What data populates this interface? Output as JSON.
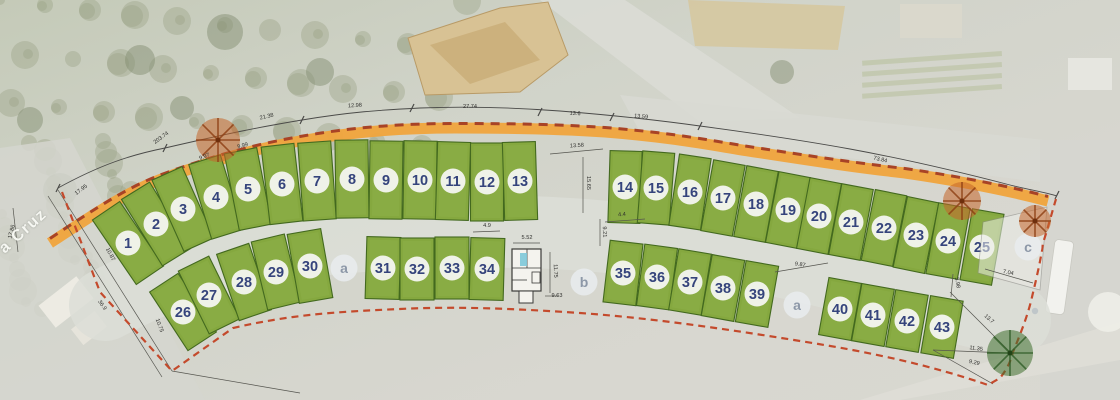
{
  "map": {
    "street_label": "a Cruz",
    "colors": {
      "plot_green": "#85a83f",
      "plot_green_light": "#93b44c",
      "plot_border": "#43691f",
      "road_orange": "#f0a43c",
      "boundary_red_dash": "#c44a2c",
      "road_overlay_dash": "#a84326",
      "measure_line": "#4a4a48",
      "number_text": "#35447c",
      "letter_text": "#8d98a8",
      "tree_orange": "#c4662a",
      "tree_green": "#3f7030",
      "building_tan": "#d8c294"
    },
    "plot_rows": [
      {
        "name": "row-north-west",
        "w": 33,
        "h": 78,
        "plots": [
          {
            "n": "1",
            "x": 128,
            "y": 243
          },
          {
            "n": "2",
            "x": 156,
            "y": 224
          },
          {
            "n": "3",
            "x": 183,
            "y": 209
          },
          {
            "n": "4",
            "x": 216,
            "y": 197
          },
          {
            "n": "5",
            "x": 248,
            "y": 189
          },
          {
            "n": "6",
            "x": 282,
            "y": 184
          },
          {
            "n": "7",
            "x": 317,
            "y": 181
          },
          {
            "n": "8",
            "x": 352,
            "y": 179
          },
          {
            "n": "9",
            "x": 386,
            "y": 180
          },
          {
            "n": "10",
            "x": 420,
            "y": 180
          },
          {
            "n": "11",
            "x": 453,
            "y": 181
          },
          {
            "n": "12",
            "x": 487,
            "y": 182
          },
          {
            "n": "13",
            "x": 520,
            "y": 181
          }
        ]
      },
      {
        "name": "row-north-east",
        "w": 32,
        "h": 72,
        "plots": [
          {
            "n": "14",
            "x": 625,
            "y": 187
          },
          {
            "n": "15",
            "x": 656,
            "y": 188
          },
          {
            "n": "16",
            "x": 690,
            "y": 192
          },
          {
            "n": "17",
            "x": 723,
            "y": 198
          },
          {
            "n": "18",
            "x": 756,
            "y": 204
          },
          {
            "n": "19",
            "x": 788,
            "y": 210
          },
          {
            "n": "20",
            "x": 819,
            "y": 216
          },
          {
            "n": "21",
            "x": 851,
            "y": 222
          },
          {
            "n": "22",
            "x": 884,
            "y": 228
          },
          {
            "n": "23",
            "x": 916,
            "y": 235
          },
          {
            "n": "24",
            "x": 948,
            "y": 241
          },
          {
            "n": "25",
            "x": 982,
            "y": 247
          }
        ]
      },
      {
        "name": "row-south-west-a",
        "w": 34,
        "h": 70,
        "plots": [
          {
            "n": "26",
            "x": 183,
            "y": 312
          },
          {
            "n": "27",
            "x": 209,
            "y": 295
          },
          {
            "n": "28",
            "x": 244,
            "y": 282
          },
          {
            "n": "29",
            "x": 276,
            "y": 272
          },
          {
            "n": "30",
            "x": 310,
            "y": 266
          }
        ]
      },
      {
        "name": "row-south-west-b",
        "w": 34,
        "h": 62,
        "plots": [
          {
            "n": "31",
            "x": 383,
            "y": 268
          },
          {
            "n": "32",
            "x": 417,
            "y": 269
          },
          {
            "n": "33",
            "x": 452,
            "y": 268
          },
          {
            "n": "34",
            "x": 487,
            "y": 269
          }
        ]
      },
      {
        "name": "row-south-east-a",
        "w": 33,
        "h": 62,
        "plots": [
          {
            "n": "35",
            "x": 623,
            "y": 273
          },
          {
            "n": "36",
            "x": 657,
            "y": 277
          },
          {
            "n": "37",
            "x": 690,
            "y": 282
          },
          {
            "n": "38",
            "x": 723,
            "y": 288
          },
          {
            "n": "39",
            "x": 757,
            "y": 294
          }
        ]
      },
      {
        "name": "row-south-east-b",
        "w": 33,
        "h": 58,
        "plots": [
          {
            "n": "40",
            "x": 840,
            "y": 309
          },
          {
            "n": "41",
            "x": 873,
            "y": 315
          },
          {
            "n": "42",
            "x": 907,
            "y": 321
          },
          {
            "n": "43",
            "x": 942,
            "y": 327
          }
        ]
      }
    ],
    "letter_plots": [
      {
        "n": "a",
        "x": 344,
        "y": 268
      },
      {
        "n": "b",
        "x": 584,
        "y": 282
      },
      {
        "n": "a",
        "x": 797,
        "y": 305
      },
      {
        "n": "c",
        "x": 1028,
        "y": 247
      }
    ],
    "dimension_labels": [
      {
        "t": "17.86",
        "x": 13,
        "y": 232,
        "r": -75
      },
      {
        "t": "17.95",
        "x": 82,
        "y": 191,
        "r": -37
      },
      {
        "t": "203.74",
        "x": 162,
        "y": 139,
        "r": -36
      },
      {
        "t": "9.97",
        "x": 205,
        "y": 158,
        "r": -22
      },
      {
        "t": "9.99",
        "x": 243,
        "y": 147,
        "r": -14
      },
      {
        "t": "21.38",
        "x": 267,
        "y": 118,
        "r": -13
      },
      {
        "t": "12.98",
        "x": 355,
        "y": 107,
        "r": -3
      },
      {
        "t": "27.74",
        "x": 470,
        "y": 108,
        "r": 0
      },
      {
        "t": "13.6",
        "x": 575,
        "y": 115,
        "r": 3
      },
      {
        "t": "13.59",
        "x": 641,
        "y": 118,
        "r": 5
      },
      {
        "t": "73.84",
        "x": 880,
        "y": 161,
        "r": 13
      },
      {
        "t": "13.58",
        "x": 577,
        "y": 147,
        "r": -4
      },
      {
        "t": "15.65",
        "x": 587,
        "y": 183,
        "r": 90
      },
      {
        "t": "9.21",
        "x": 603,
        "y": 232,
        "r": 87
      },
      {
        "t": "4.4",
        "x": 622,
        "y": 216,
        "r": -3
      },
      {
        "t": "4.9",
        "x": 487,
        "y": 227,
        "r": 0
      },
      {
        "t": "5.52",
        "x": 527,
        "y": 239,
        "r": 0
      },
      {
        "t": "11.75",
        "x": 554,
        "y": 271,
        "r": 88
      },
      {
        "t": "9.63",
        "x": 557,
        "y": 297,
        "r": 0
      },
      {
        "t": "9.87",
        "x": 800,
        "y": 266,
        "r": 8
      },
      {
        "t": "7.04",
        "x": 1008,
        "y": 274,
        "r": 12
      },
      {
        "t": "3.98",
        "x": 956,
        "y": 283,
        "r": 80
      },
      {
        "t": "13.7",
        "x": 988,
        "y": 320,
        "r": 42
      },
      {
        "t": "11.35",
        "x": 976,
        "y": 350,
        "r": 7
      },
      {
        "t": "9.29",
        "x": 974,
        "y": 364,
        "r": 12
      },
      {
        "t": "36.9",
        "x": 101,
        "y": 306,
        "r": 55
      },
      {
        "t": "10.75",
        "x": 158,
        "y": 326,
        "r": 70
      },
      {
        "t": "10.87",
        "x": 109,
        "y": 255,
        "r": 62
      }
    ],
    "trees": [
      {
        "type": "orange",
        "x": 218,
        "y": 140,
        "r": 22
      },
      {
        "type": "orange",
        "x": 962,
        "y": 201,
        "r": 19
      },
      {
        "type": "orange",
        "x": 1035,
        "y": 221,
        "r": 16
      },
      {
        "type": "green",
        "x": 1010,
        "y": 353,
        "r": 23
      }
    ]
  }
}
